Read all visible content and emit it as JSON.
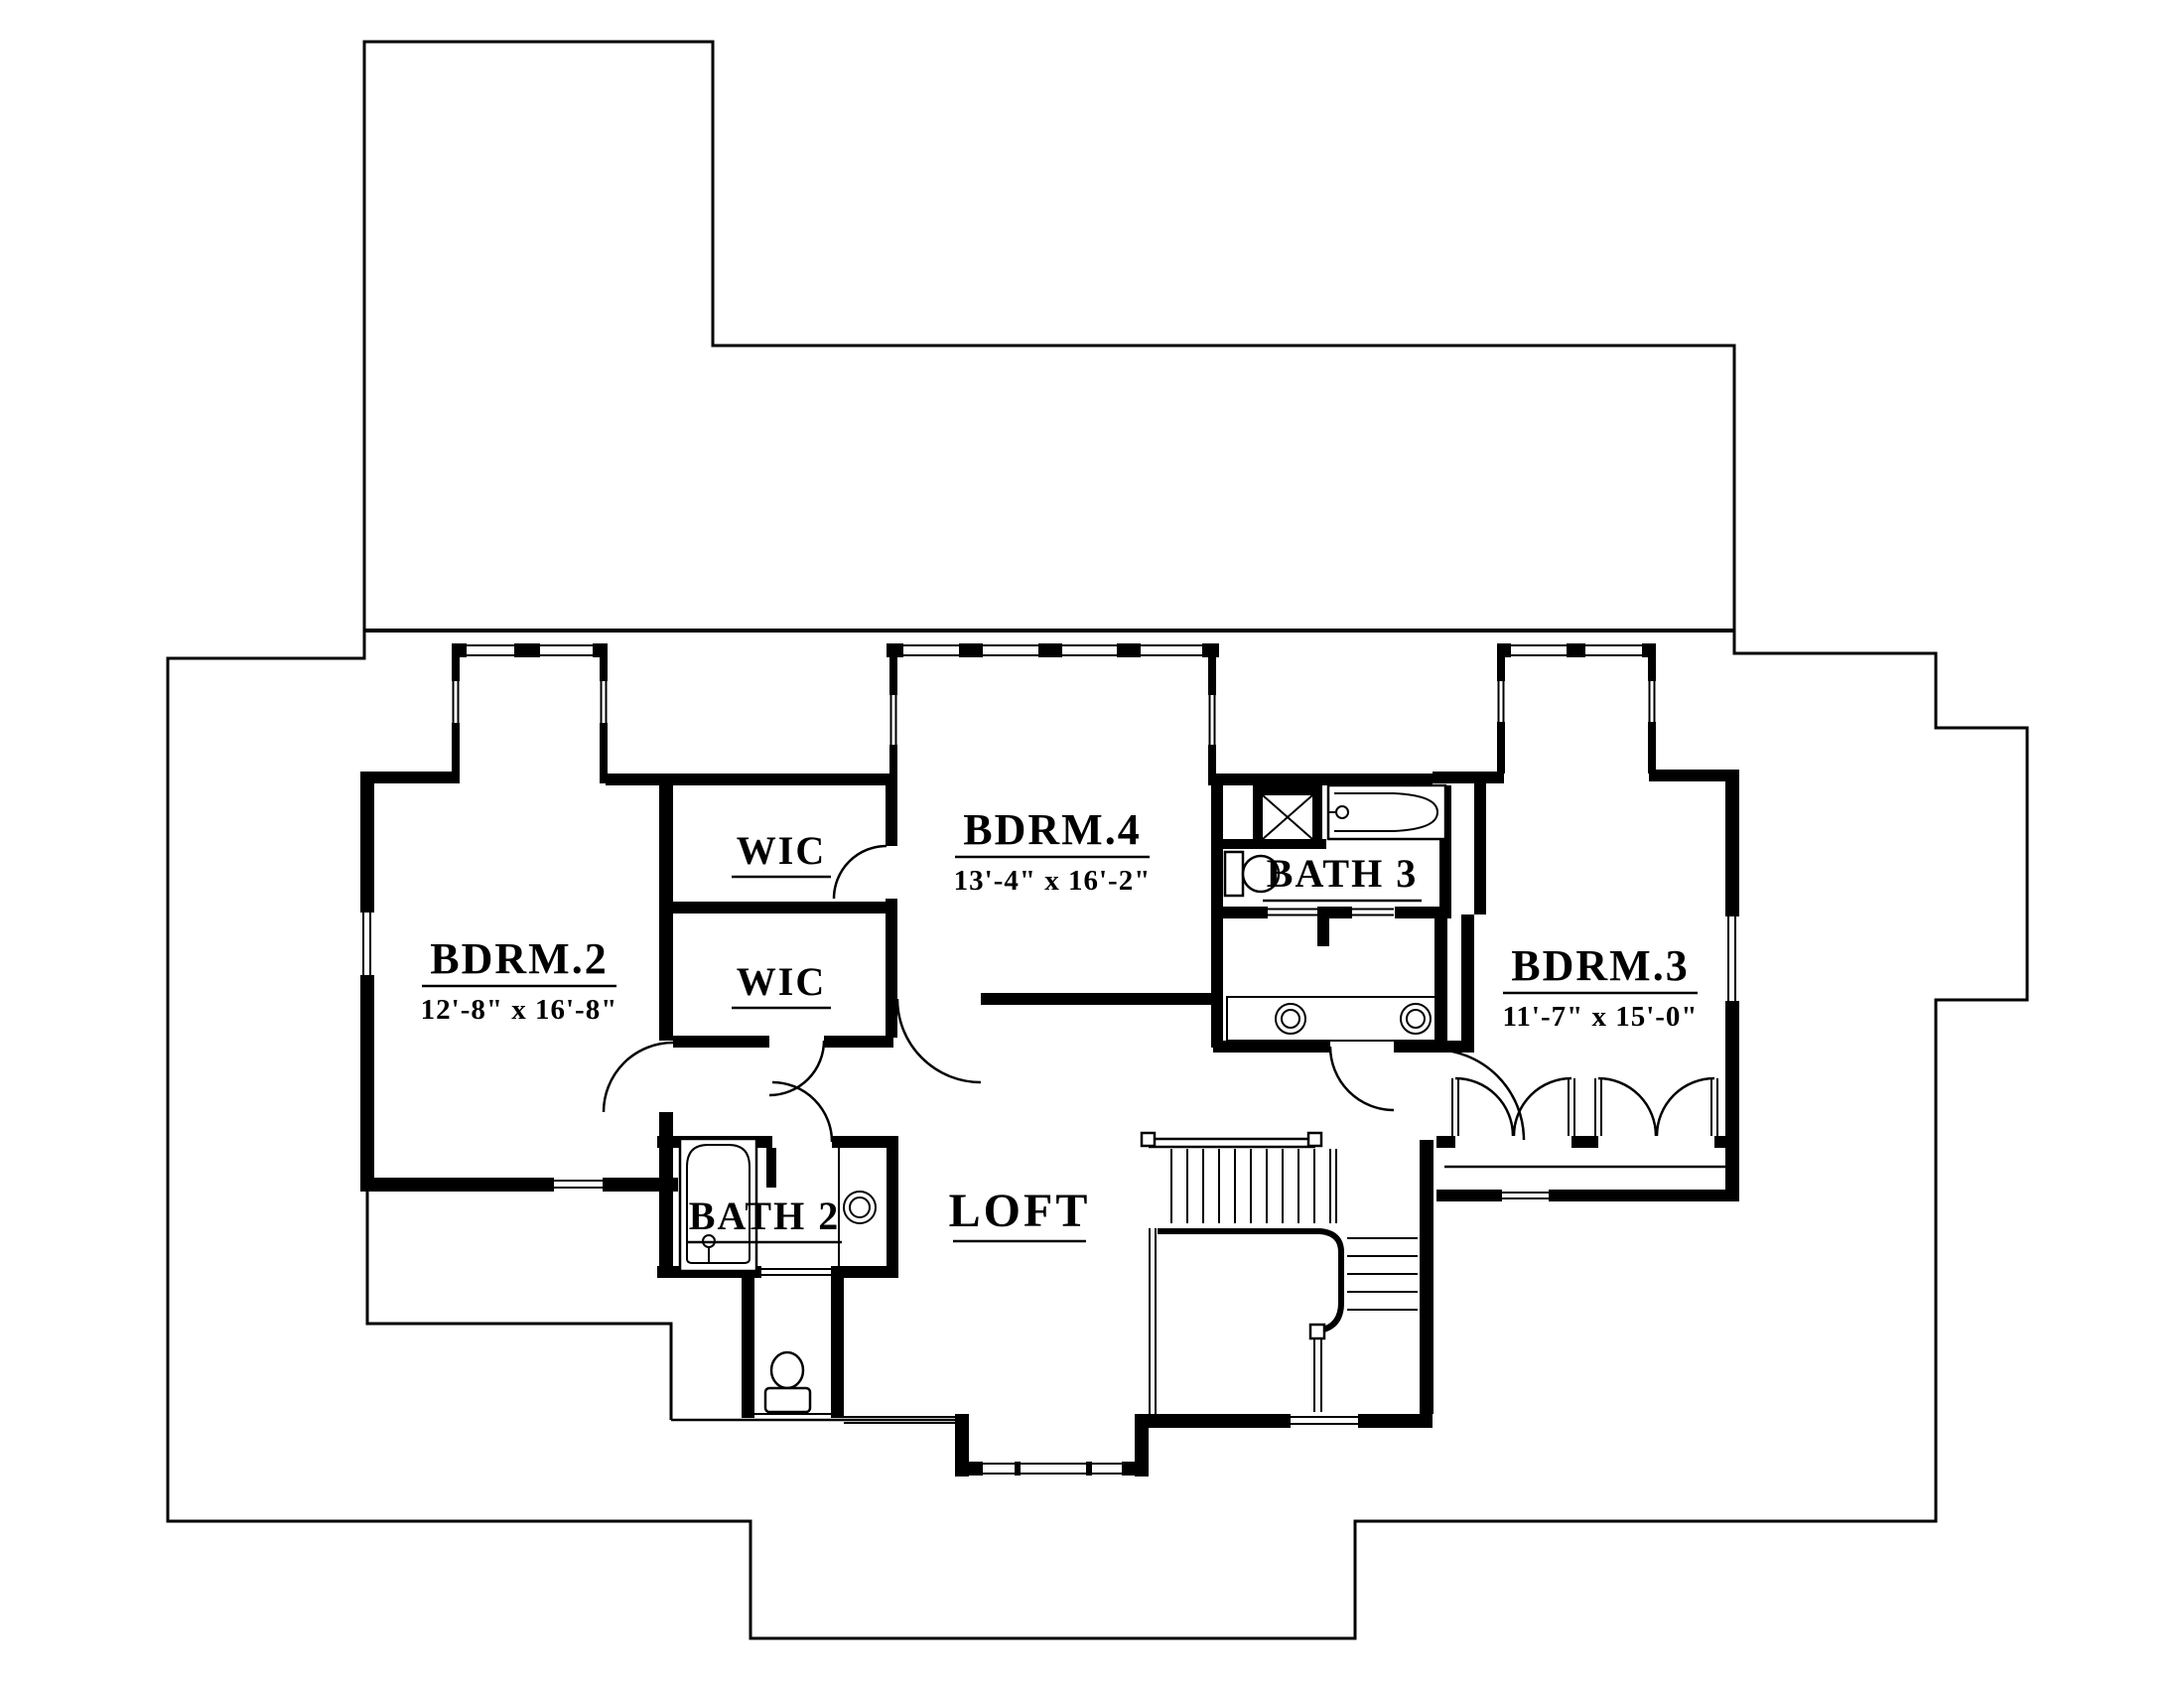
{
  "plan": {
    "title": "Second Floor Plan",
    "colors": {
      "wall": "#000000",
      "background": "#ffffff"
    },
    "rooms": {
      "bdrm2": {
        "name": "BDRM.2",
        "dims": "12'-8\" x 16'-8\""
      },
      "bdrm3": {
        "name": "BDRM.3",
        "dims": "11'-7\" x 15'-0\""
      },
      "bdrm4": {
        "name": "BDRM.4",
        "dims": "13'-4\" x 16'-2\""
      },
      "wic_upper": {
        "name": "WIC"
      },
      "wic_lower": {
        "name": "WIC"
      },
      "bath2": {
        "name": "BATH 2"
      },
      "bath3": {
        "name": "BATH 3"
      },
      "loft": {
        "name": "LOFT"
      }
    }
  }
}
